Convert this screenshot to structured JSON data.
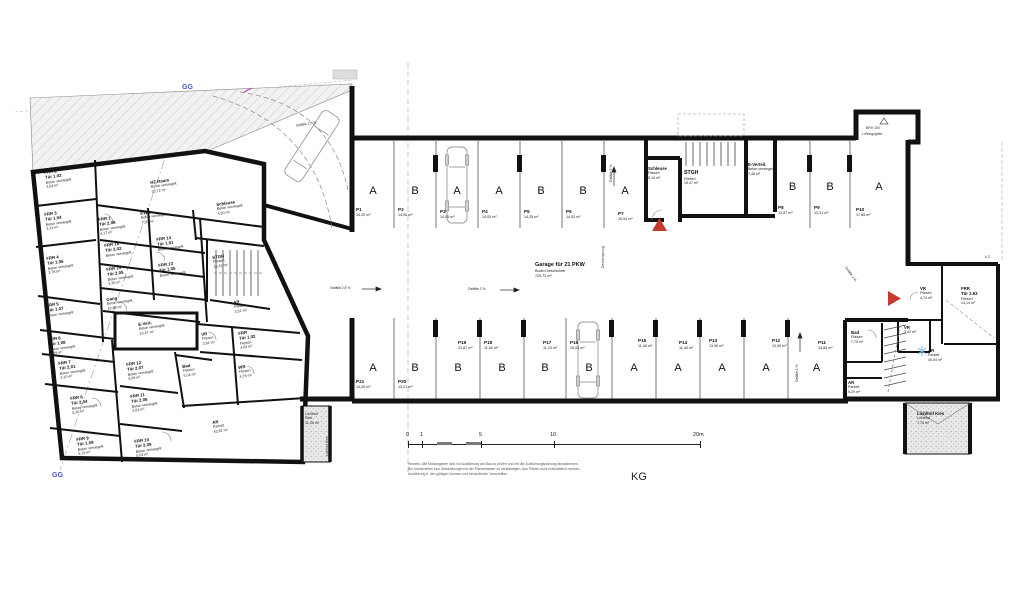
{
  "plan": {
    "level_label": "KG",
    "section_label_top": "GG",
    "section_label_bottom": "GG",
    "vent_line1": "BRH 150",
    "vent_line2": "Lüftungsgitter",
    "stair_note": "6 Z"
  },
  "scale_bar": {
    "tick_0": "0",
    "tick_1": "1",
    "tick_5": "5",
    "tick_10": "10",
    "tick_20": "20m"
  },
  "notes": {
    "line1": "Hinweis: Alle Maßangaben sind vor Ausführung am Bau zu prüfen und mit der Ausführungsplanung abzustimmen.",
    "line2": "Bei Unklarheiten bzw. Abweichungen ist der Planverfasser zu verständigen. Aus Plänen nicht maßstäblich messen.",
    "line3": "Ausführung lt. den gültigen Normen und behördlichen Vorschriften."
  },
  "garage": {
    "title": "Garage für 21 PKW",
    "finish": "Boden beschichtet",
    "area": "729,72 m²",
    "deck_label": "Deckensprung",
    "slope_aisle_left": "Gefälle 2,5 %",
    "slope_aisle_mid": "Gefälle 2 %",
    "slope_right_v": "Gefälle 2 %",
    "slope_top_v": "Gefälle 2 %",
    "slope_ramp": "Gefälle 2,5 %",
    "slope_wing": "Gefälle 2 %",
    "stalls_top": [
      {
        "id": "P1",
        "letter": "A",
        "area": "14,20 m²"
      },
      {
        "id": "P2",
        "letter": "B",
        "area": "14,06 m²"
      },
      {
        "id": "P3",
        "letter": "A",
        "area": "14,05 m²"
      },
      {
        "id": "P4",
        "letter": "A",
        "area": "14,05 m²"
      },
      {
        "id": "P5",
        "letter": "B",
        "area": "14,25 m²"
      },
      {
        "id": "P6",
        "letter": "B",
        "area": "14,03 m²"
      },
      {
        "id": "P7",
        "letter": "A",
        "area": "15,04 m²"
      }
    ],
    "stalls_mid": [
      {
        "id": "P8",
        "letter": "B",
        "area": "13,87 m²"
      },
      {
        "id": "P9",
        "letter": "B",
        "area": "13,31 m²"
      },
      {
        "id": "P10",
        "letter": "A",
        "area": "17,85 m²"
      }
    ],
    "stalls_bottom": [
      {
        "id": "P21",
        "letter": "A",
        "area": "14,20 m²"
      },
      {
        "id": "P20",
        "letter": "B",
        "area": "13,21 m²"
      },
      {
        "id": "P19",
        "letter": "B",
        "area": "13,87 m²"
      },
      {
        "id": "P18",
        "letter": "B",
        "area": "11,52 m²"
      },
      {
        "id": "P17",
        "letter": "B",
        "area": "11,23 m²"
      },
      {
        "id": "P16",
        "letter": "B",
        "area": "15,03 m²"
      },
      {
        "id": "P15",
        "letter": "A",
        "area": "11,40 m²"
      },
      {
        "id": "P14",
        "letter": "A",
        "area": "11,40 m²"
      },
      {
        "id": "P13",
        "letter": "A",
        "area": "13,90 m²"
      },
      {
        "id": "P12",
        "letter": "A",
        "area": "13,50 m²"
      },
      {
        "id": "P11",
        "letter": "A",
        "area": "14,84 m²"
      }
    ],
    "rooms": {
      "schleuse": {
        "n": "Schleuse",
        "f": "Fliesen",
        "a": "5,10 m²"
      },
      "stgh": {
        "n": "STGH",
        "f": "Fliesen",
        "a": "15,47 m²"
      },
      "everteil": {
        "n": "E-Verteil.",
        "f": "Beton versiegelt",
        "a": "7,48 m²"
      }
    }
  },
  "wing": {
    "rooms": {
      "vr1": {
        "n": "VR",
        "f": "Fliesen",
        "a": "4,74 m²"
      },
      "frr": {
        "n": "FRR",
        "d": "Tür 2.63",
        "f": "Fliesen",
        "a": "13,14 m²"
      },
      "vr2": {
        "n": "VR",
        "f": "Fliesen",
        "a": "3,42 m²"
      },
      "bad": {
        "n": "Bad",
        "f": "Fliesen",
        "a": "7,75 m²"
      },
      "ar_klein": {
        "n": "AR",
        "f": "Parkett",
        "a": "5,29 m²"
      },
      "ar": {
        "n": "AR",
        "f": "Parkett",
        "a": "40,04 m²"
      },
      "lichthof": {
        "n": "Lichthof Kies",
        "f": "Lichthof",
        "a": "7,75 m²"
      }
    }
  },
  "house": {
    "lichthof": {
      "n": "Lichthof",
      "d": "Kies",
      "a": "11,35 m²",
      "v": "Lichthof Kies"
    },
    "rooms": {
      "frr2": {
        "n": "FRR 2",
        "d": "Tür 1.03",
        "f": "Beton versiegelt",
        "a": "3,64 m²"
      },
      "frr3": {
        "n": "FRR 3",
        "d": "Tür 1.04",
        "f": "Beton versiegelt",
        "a": "3,14 m²"
      },
      "hz": {
        "n": "HZ Raum",
        "f": "Beton versiegelt",
        "a": "33,72 m²"
      },
      "kwa": {
        "n": "KWA",
        "f": "Beton versiegelt",
        "a": "7,30 m²"
      },
      "schleuse": {
        "n": "Schleuse",
        "f": "Beton versiegelt",
        "a": "4,50 m²"
      },
      "frr1": {
        "n": "FRR 1",
        "d": "Tür 2.08",
        "f": "Beton versiegelt",
        "a": "4,17 m²"
      },
      "frr16": {
        "n": "FRR 16",
        "d": "Tür 2.02",
        "f": "Beton versiegelt",
        "a": "4,05 m²"
      },
      "frr14": {
        "n": "FRR 14",
        "d": "Tür 1.01",
        "f": "Beton versiegelt",
        "a": "3,88 m²"
      },
      "frr15": {
        "n": "FRR 15",
        "d": "Tür 2.05",
        "f": "Beton versiegelt",
        "a": "4,35 m²"
      },
      "frr13": {
        "n": "FRR 13",
        "d": "Tür 1.05",
        "f": "Beton versiegelt",
        "a": "3,97 m²"
      },
      "frr4": {
        "n": "FRR 4",
        "d": "Tür 1.06",
        "f": "Beton versiegelt",
        "a": "3,78 m²"
      },
      "stgh": {
        "n": "STGH",
        "f": "Fliesen",
        "a": "15,41 m²"
      },
      "gang": {
        "n": "Gang",
        "f": "Beton versiegelt",
        "a": "10,88 m²"
      },
      "ar1": {
        "n": "AR",
        "f": "Fliesen",
        "a": "3,51 m²"
      },
      "frr5": {
        "n": "FRR 5",
        "d": "Tür 1.07",
        "f": "Beton versiegelt",
        "a": "5,02 m²"
      },
      "frr102": {
        "n": "FRR",
        "d": "Tür 1.02",
        "f": "Fliesen",
        "a": "4,62 m²"
      },
      "vr": {
        "n": "VR",
        "f": "Fliesen",
        "a": "3,82 m²"
      },
      "evert": {
        "n": "E-Vert.",
        "f": "Beton versiegelt",
        "a": "10,47 m²"
      },
      "frr6": {
        "n": "FRR 6",
        "d": "Tür 1.08",
        "f": "Beton versiegelt",
        "a": "4,29 m²"
      },
      "frr7": {
        "n": "FRR 7",
        "d": "Tür 2.01",
        "f": "Beton versiegelt",
        "a": "4,10 m²"
      },
      "frr12": {
        "n": "FRR 12",
        "d": "Tür 2.07",
        "f": "Beton versiegelt",
        "a": "5,06 m²"
      },
      "frr11": {
        "n": "FRR 11",
        "d": "Tür 2.06",
        "f": "Beton versiegelt",
        "a": "3,81 m²"
      },
      "frr8": {
        "n": "FRR 8",
        "d": "Tür 2.04",
        "f": "Beton versiegelt",
        "a": "5,15 m²"
      },
      "bad": {
        "n": "Bad",
        "f": "Fliesen",
        "a": "5,04 m²"
      },
      "wr": {
        "n": "WR",
        "f": "Fliesen",
        "a": "4,78 m²"
      },
      "frr9": {
        "n": "FRR 9",
        "d": "Tür 1.09",
        "f": "Beton versiegelt",
        "a": "5,15 m²"
      },
      "frr10": {
        "n": "FRR 10",
        "d": "Tür 2.09",
        "f": "Beton versiegelt",
        "a": "5,03 m²"
      },
      "ar2": {
        "n": "AR",
        "f": "Parkett",
        "a": "42,81 m²"
      }
    }
  }
}
